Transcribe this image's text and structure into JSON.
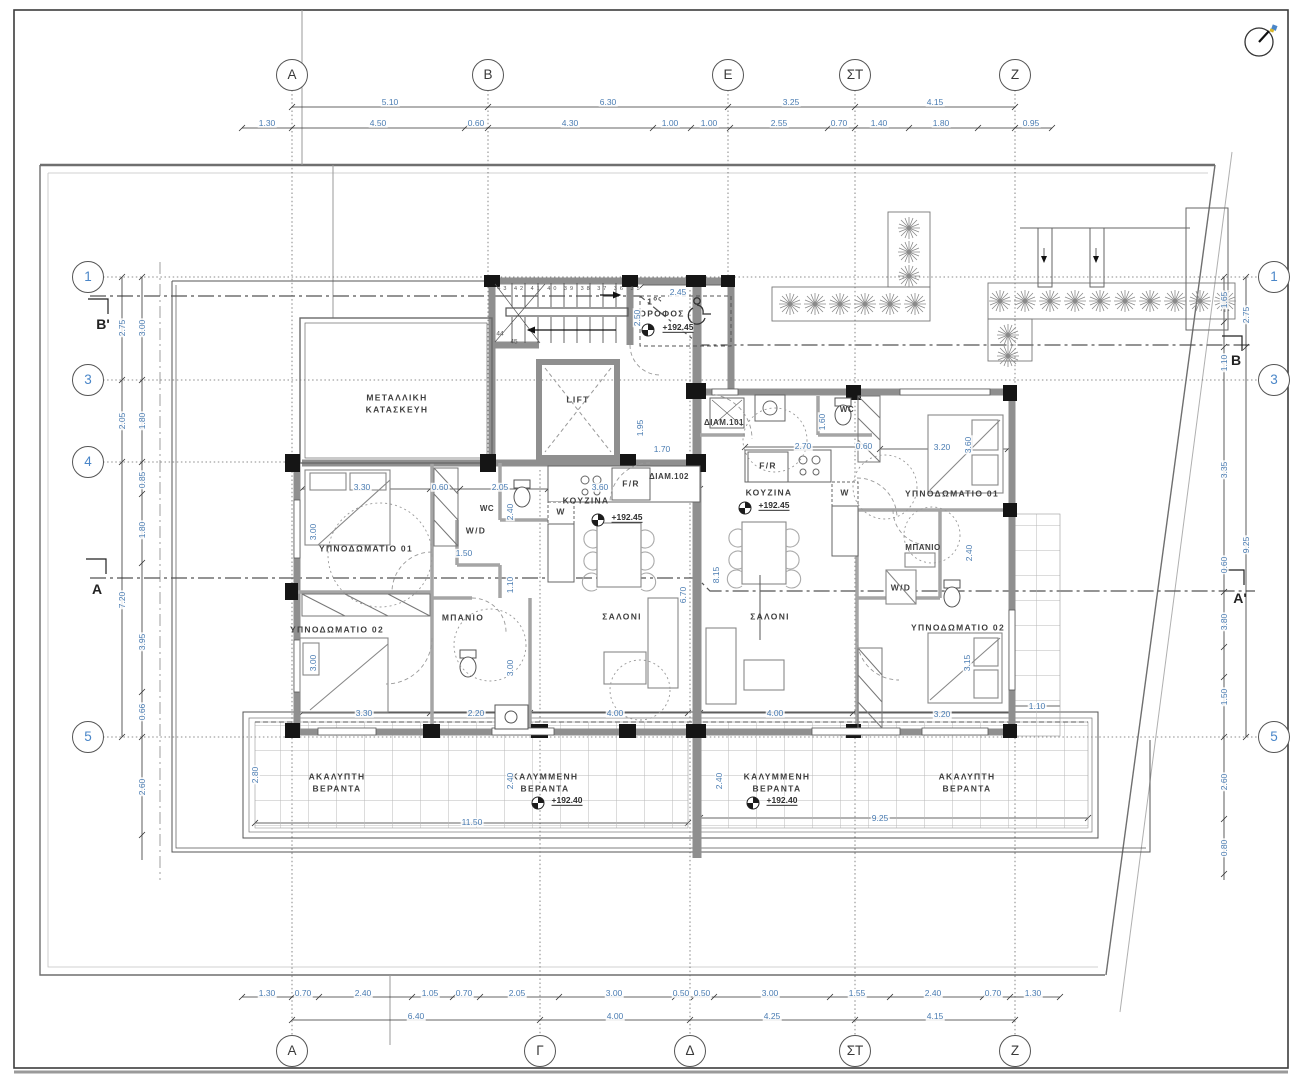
{
  "grid": {
    "top": [
      "A",
      "B",
      "E",
      "ΣΤ",
      "Z"
    ],
    "bottom": [
      "A",
      "Γ",
      "Δ",
      "ΣΤ",
      "Z"
    ],
    "left": [
      "1",
      "3",
      "4",
      "5"
    ],
    "right": [
      "1",
      "3",
      "5"
    ]
  },
  "sections": {
    "b_left": "B'",
    "a_left": "A",
    "b_right": "B",
    "a_right": "A'"
  },
  "rooms": {
    "metal1": "ΜΕΤΑΛΛΙΚΗ",
    "metal2": "ΚΑΤΑΣΚΕΥΗ",
    "bed1": "ΥΠΝΟΔΩΜΑΤΙΟ 01",
    "bed2": "ΥΠΝΟΔΩΜΑΤΙΟ 02",
    "bath": "ΜΠΑΝΙΟ",
    "kitchen": "ΚΟΥΖΙΝΑ",
    "salon": "ΣΑΛΟΝΙ",
    "wc": "WC",
    "wd": "W/D",
    "w": "W",
    "fr": "F/R",
    "lift": "LIFT",
    "ver_covered": "ΚΑΛΥΜΜΕΝΗ",
    "ver_uncovered": "ΑΚΑΛΥΠΤΗ",
    "veranda": "ΒΕΡΑΝΤΑ"
  },
  "apartments": {
    "right": "ΔΙΑΜ.101",
    "left": "ΔΙΑΜ.102"
  },
  "levels": {
    "floor": "+192.45",
    "veranda": "+192.40"
  },
  "storey": {
    "num": "1",
    "sup": "ος",
    "word": "ΟΡΟΦΟΣ"
  },
  "stairs": {
    "top_numbers": "43 42 41 40 39 38 37 36 35",
    "n44": "44",
    "n45": "45"
  },
  "dims": {
    "top_major": [
      "5.10",
      "6.30",
      "3.25",
      "4.15"
    ],
    "top_minor": [
      "1.30",
      "4.50",
      "0.60",
      "4.30",
      "1.00",
      "1.00",
      "2.55",
      "0.70",
      "1.40",
      "1.80",
      "0.95"
    ],
    "bottom_minor": [
      "1.30",
      "0.70",
      "2.40",
      "1.05",
      "0.70",
      "2.05",
      "3.00",
      "0.50",
      "0.50",
      "3.00",
      "1.55",
      "2.40",
      "0.70",
      "1.30"
    ],
    "bottom_major": [
      "6.40",
      "4.00",
      "4.25",
      "4.15"
    ],
    "left_a": [
      "2.75",
      "2.05",
      "7.20"
    ],
    "left_b": [
      "3.00",
      "1.80",
      "0.85",
      "1.80",
      "3.95",
      "0.66",
      "2.60"
    ],
    "right_a": [
      "1.65",
      "1.10",
      "3.35",
      "0.60",
      "3.80",
      "1.50",
      "2.60",
      "0.80"
    ],
    "right_b": [
      "2.75",
      "9.25"
    ]
  },
  "in": {
    "d330a": "3.30",
    "d060a": "0.60",
    "d205": "2.05",
    "d360a": "3.60",
    "d240a": "2.40",
    "d300a": "3.00",
    "d150": "1.50",
    "d110a": "1.10",
    "d300b": "3.00",
    "d300c": "3.00",
    "d670": "6.70",
    "d245": "2.45",
    "d250": "2.50",
    "d195": "1.95",
    "d170": "1.70",
    "d160": "1.60",
    "d270": "2.70",
    "d060b": "0.60",
    "d320a": "3.20",
    "d360b": "3.60",
    "d815": "8.15",
    "d240b": "2.40",
    "d315": "3.15",
    "d330b": "3.30",
    "d220": "2.20",
    "d400a": "4.00",
    "d400b": "4.00",
    "d320b": "3.20",
    "d110b": "1.10",
    "d1150": "11.50",
    "d925": "9.25",
    "d240c": "2.40",
    "d240d": "2.40",
    "d280": "2.80"
  }
}
